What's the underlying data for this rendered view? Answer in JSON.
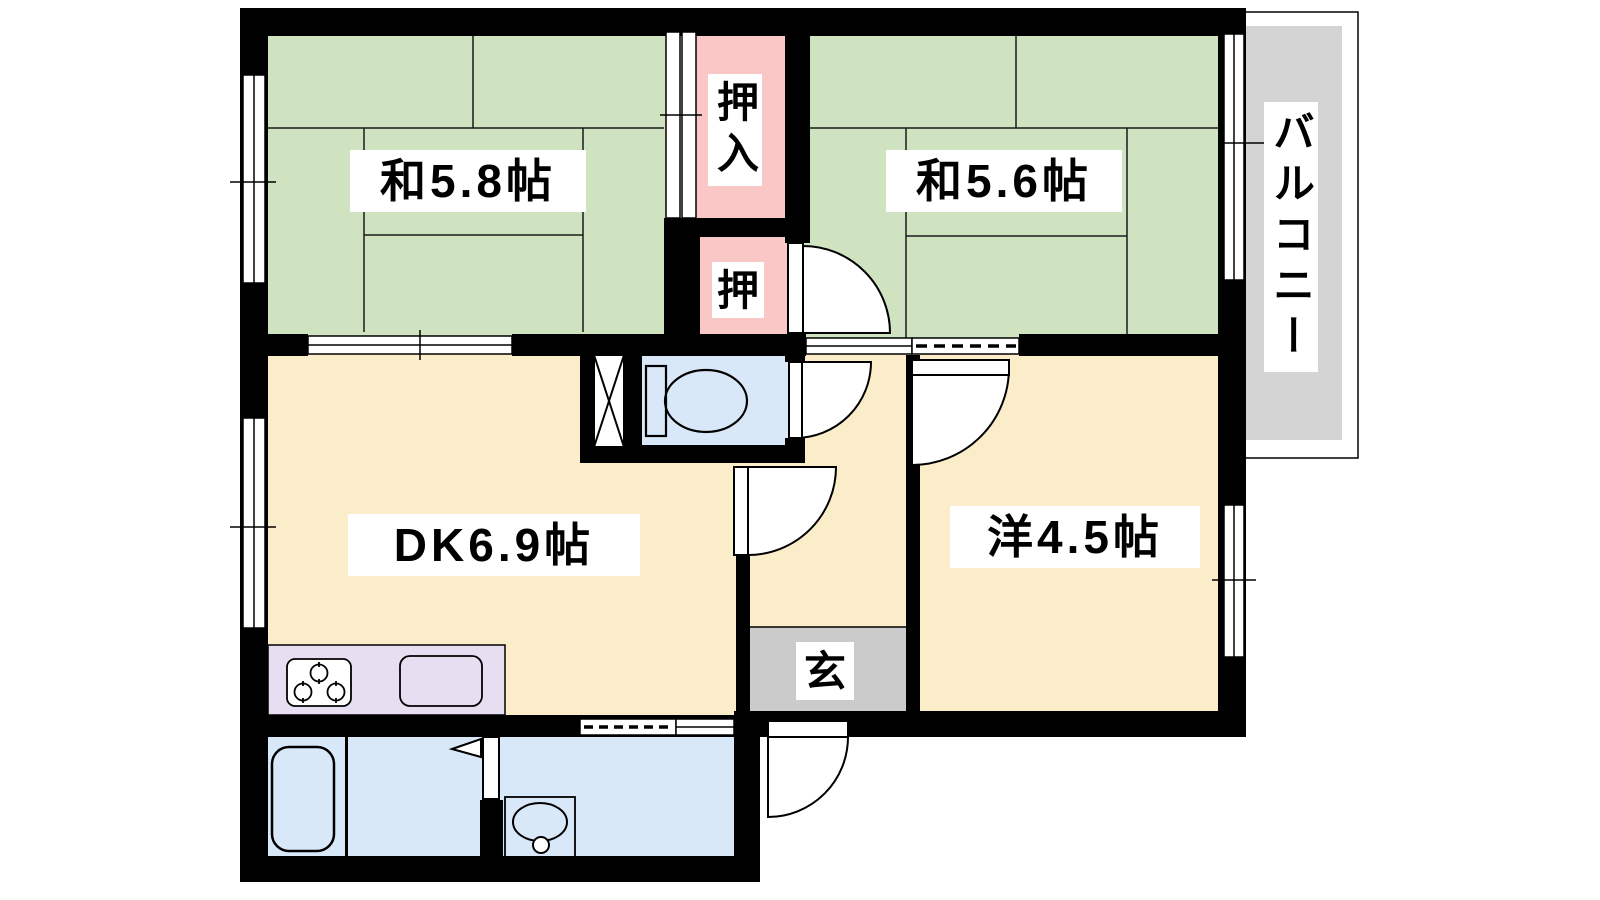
{
  "plan": {
    "type": "apartment-floor-plan",
    "rooms": {
      "wa58": {
        "label": "和5.8帖"
      },
      "wa56": {
        "label": "和5.6帖"
      },
      "dk": {
        "label": "DK6.9帖"
      },
      "yo45": {
        "label": "洋4.5帖"
      },
      "oshiire": {
        "label": "押入"
      },
      "oshi": {
        "label": "押"
      },
      "genkan": {
        "label": "玄"
      },
      "balcony": {
        "label": "バルコニー"
      }
    },
    "fixtures": {
      "toilet": "toilet-icon",
      "bathtub": "bathtub-icon",
      "washbasin": "washbasin-icon",
      "stove": "stove-icon",
      "sink": "kitchen-sink-icon",
      "pipe_space": "pipe-space-x-icon"
    }
  },
  "colors": {
    "tatami": "#cfe3c1",
    "closet": "#f9c7c5",
    "floor": "#fcedca",
    "water": "#d9e8f8",
    "balcony": "#d4d4d4",
    "genkan": "#cbcbcb",
    "kitchen": "#e8def2",
    "label_bg": "#ffffff",
    "wall": "#000000"
  }
}
